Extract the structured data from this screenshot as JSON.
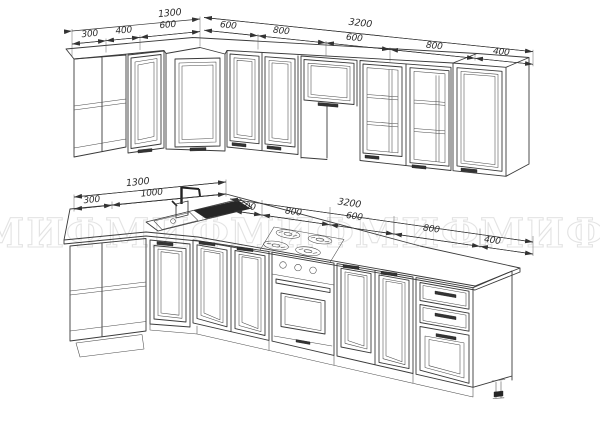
{
  "watermark": {
    "text": "МИФ",
    "color": "#e3e3e3"
  },
  "drawing": {
    "upper_row": {
      "total_left": "1300",
      "segments_left": [
        "300",
        "400",
        "600"
      ],
      "total_right": "3200",
      "segments_right": [
        "600",
        "800",
        "600",
        "800",
        "400"
      ]
    },
    "lower_row": {
      "total_left": "1300",
      "segments_left": [
        "300",
        "1000"
      ],
      "total_right": "3200",
      "segments_right": [
        "600",
        "800",
        "600",
        "800",
        "400"
      ]
    }
  },
  "style": {
    "line_color": "#3a3a3a",
    "dark_fill": "#262626"
  }
}
